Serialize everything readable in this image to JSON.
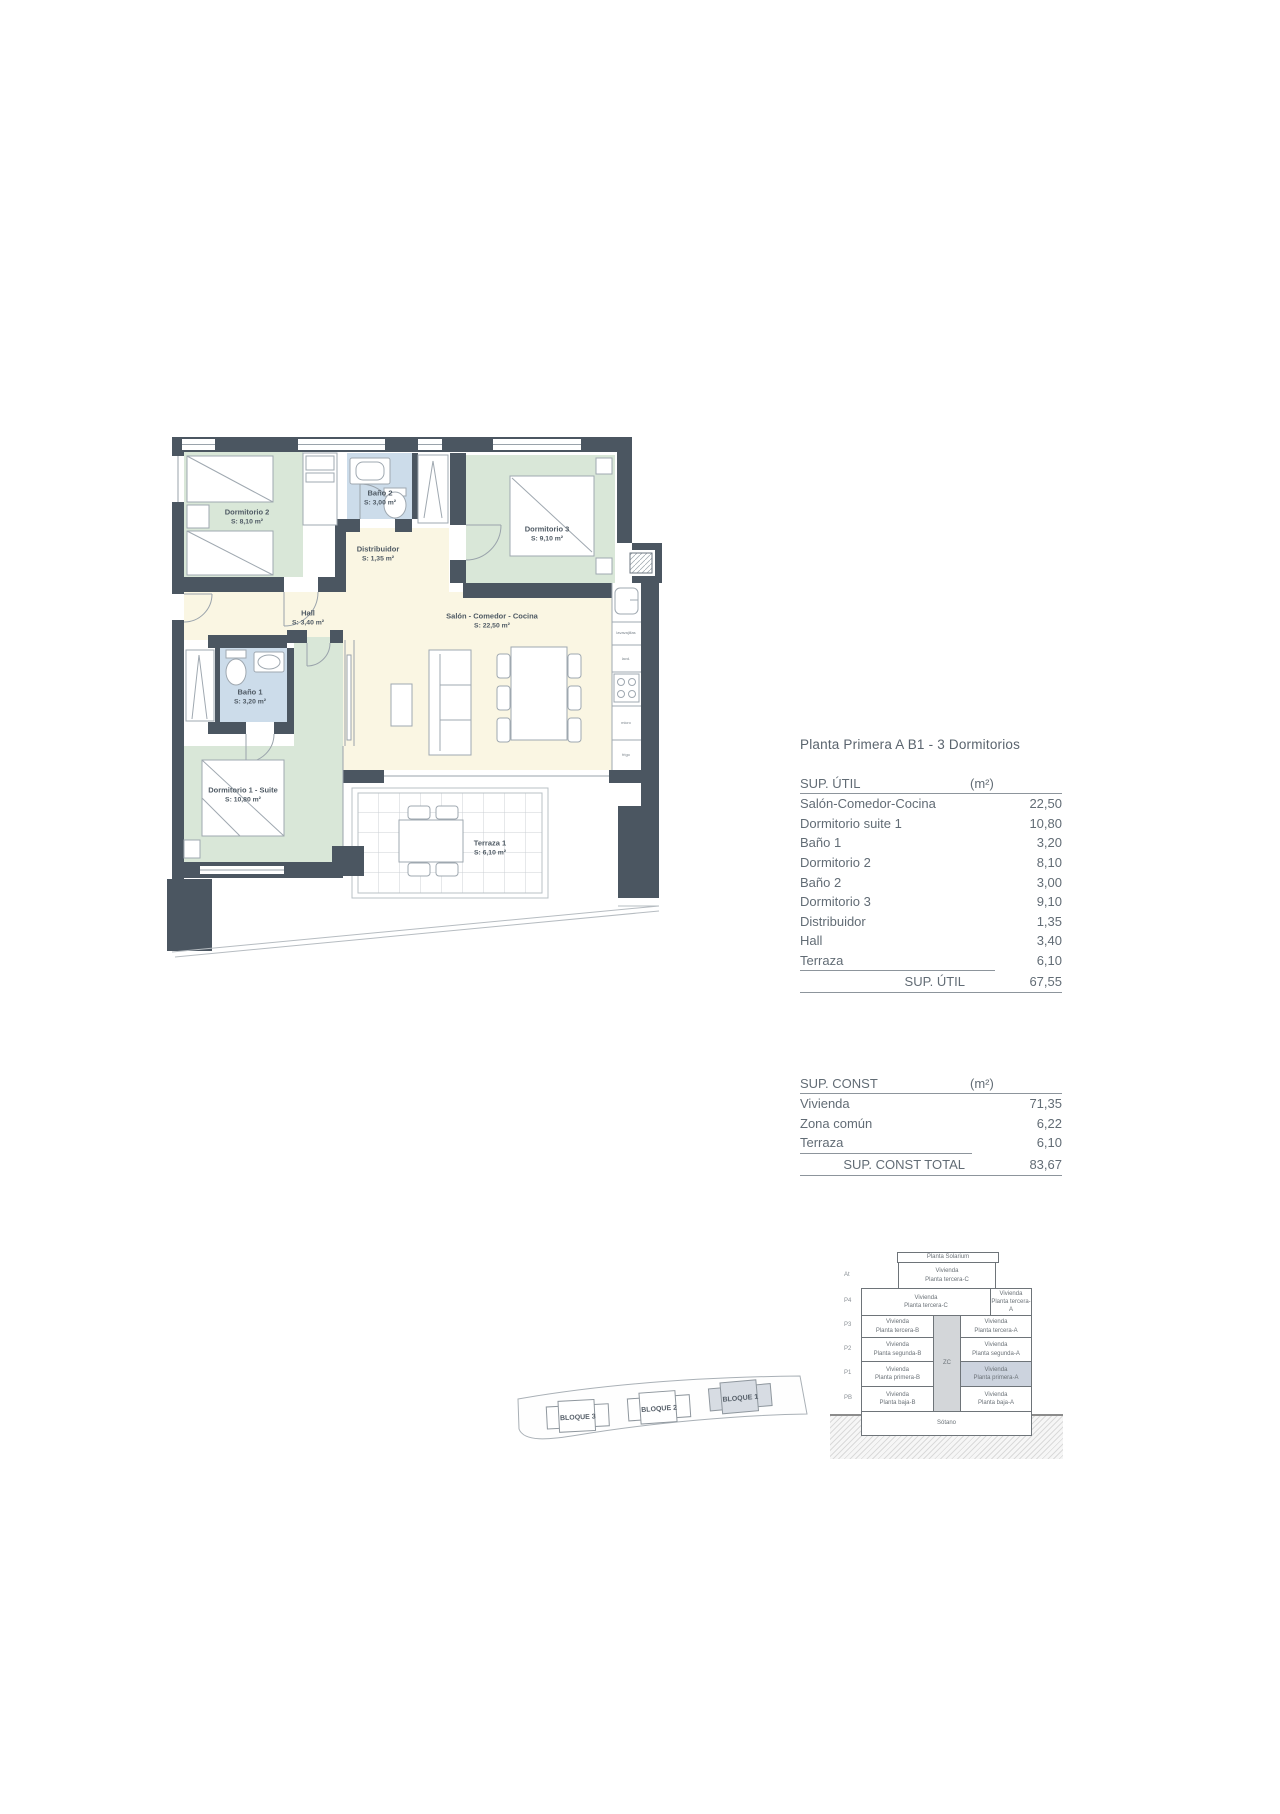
{
  "title": "Planta Primera A B1 - 3 Dormitorios",
  "colors": {
    "wall": "#4b5661",
    "room_green": "#d9e7d8",
    "room_blue": "#ccdcea",
    "room_cream": "#faf6e3",
    "section_highlight": "#ccd3de"
  },
  "floor_plan": {
    "rooms": [
      {
        "name": "Dormitorio 2",
        "area": "S: 8,10 m²"
      },
      {
        "name": "Baño 2",
        "area": "S: 3,00 m²"
      },
      {
        "name": "Distribuidor",
        "area": "S: 1,35 m²"
      },
      {
        "name": "Dormitorio 3",
        "area": "S: 9,10 m²"
      },
      {
        "name": "Hall",
        "area": "S: 3,40 m²"
      },
      {
        "name": "Salón - Comedor - Cocina",
        "area": "S: 22,50 m²"
      },
      {
        "name": "Baño 1",
        "area": "S: 3,20 m²"
      },
      {
        "name": "Dormitorio 1 - Suite",
        "area": "S: 10,80 m²"
      },
      {
        "name": "Terraza 1",
        "area": "S: 6,10 m²"
      }
    ],
    "appliances": {
      "a1": "lavavajillas",
      "a2": "lavd.",
      "a3": "micro",
      "a4": "frigo"
    }
  },
  "sup_util": {
    "header": "SUP. ÚTIL",
    "unit": "(m²)",
    "rows": [
      [
        "Salón-Comedor-Cocina",
        "22,50"
      ],
      [
        "Dormitorio suite 1",
        "10,80"
      ],
      [
        "Baño 1",
        "3,20"
      ],
      [
        "Dormitorio 2",
        "8,10"
      ],
      [
        "Baño 2",
        "3,00"
      ],
      [
        "Dormitorio 3",
        "9,10"
      ],
      [
        "Distribuidor",
        "1,35"
      ],
      [
        "Hall",
        "3,40"
      ],
      [
        "Terraza",
        "6,10"
      ]
    ],
    "total_label": "SUP. ÚTIL",
    "total_value": "67,55"
  },
  "sup_const": {
    "header": "SUP. CONST",
    "unit": "(m²)",
    "rows": [
      [
        "Vivienda",
        "71,35"
      ],
      [
        "Zona común",
        "6,22"
      ],
      [
        "Terraza",
        "6,10"
      ]
    ],
    "total_label": "SUP. CONST TOTAL",
    "total_value": "83,67"
  },
  "section": {
    "solarium": "Planta Solarium",
    "tags": [
      "At",
      "P4",
      "P3",
      "P2",
      "P1",
      "PB"
    ],
    "cells": {
      "at": [
        "Vivienda",
        "Planta tercera-C"
      ],
      "p4l": [
        "Vivienda",
        "Planta tercera-C"
      ],
      "p4r": [
        "Vivienda",
        "Planta tercera-A"
      ],
      "p3l": [
        "Vivienda",
        "Planta tercera-B"
      ],
      "p3r": [
        "Vivienda",
        "Planta tercera-A"
      ],
      "p2l": [
        "Vivienda",
        "Planta segunda-B"
      ],
      "p2r": [
        "Vivienda",
        "Planta segunda-A"
      ],
      "p1l": [
        "Vivienda",
        "Planta primera-B"
      ],
      "p1r": [
        "Vivienda",
        "Planta primera-A"
      ],
      "pbl": [
        "Vivienda",
        "Planta baja-B"
      ],
      "pbr": [
        "Vivienda",
        "Planta baja-A"
      ]
    },
    "core": "ZC",
    "basement": "Sótano"
  },
  "site": {
    "blocks": [
      "BLOQUE 3",
      "BLOQUE 2",
      "BLOQUE 1"
    ]
  }
}
